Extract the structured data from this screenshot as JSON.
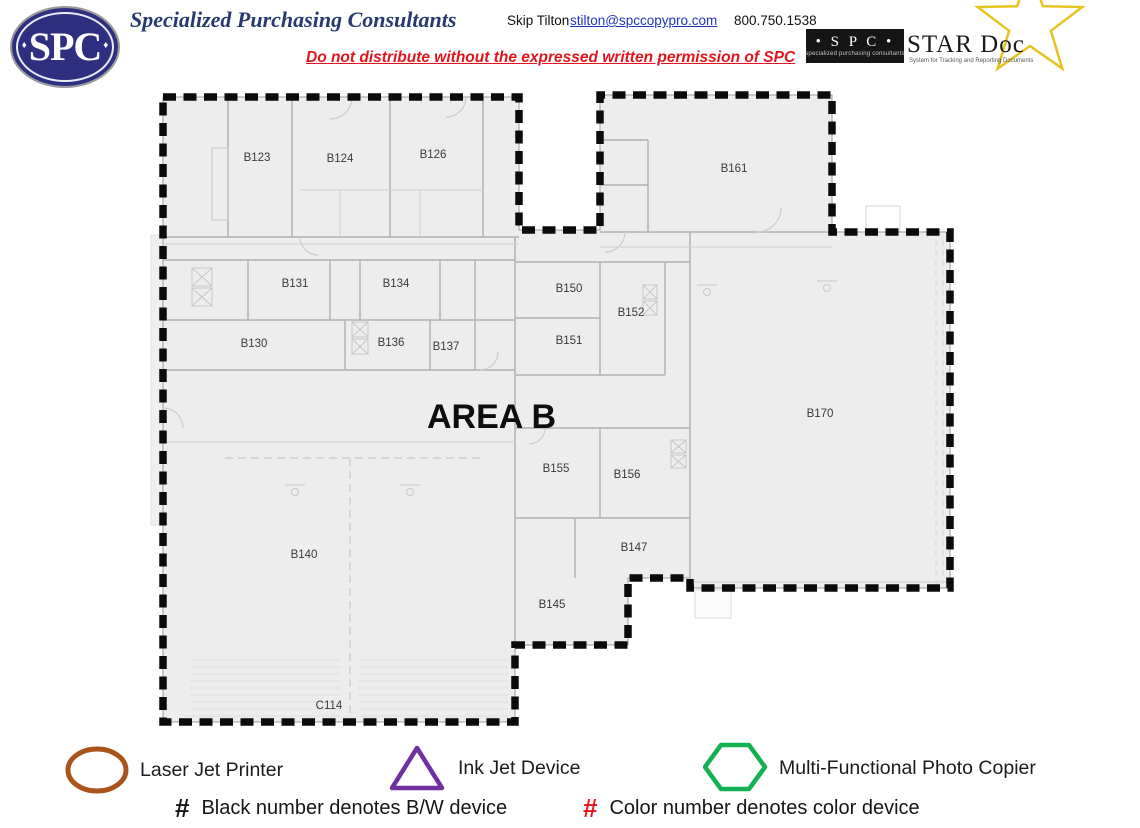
{
  "header": {
    "logo_text": "SPC",
    "logo_diamond": "♦",
    "company": "Specialized Purchasing Consultants",
    "contact_name": "Skip Tilton",
    "contact_email": "stilton@spccopypro.com",
    "contact_phone": "800.750.1538",
    "warning": "Do not distribute without the expressed written permission of SPC",
    "stardoc": {
      "spc_label": "• S P C •",
      "spc_sub": "specialized purchasing consultants",
      "title": "STAR Doc",
      "subtitle": "System for Tracking and Reporting Documents"
    }
  },
  "plan": {
    "area_label": "AREA B",
    "rooms": [
      {
        "label": "B123",
        "x": 257,
        "y": 161
      },
      {
        "label": "B124",
        "x": 340,
        "y": 162
      },
      {
        "label": "B126",
        "x": 433,
        "y": 158
      },
      {
        "label": "B161",
        "x": 734,
        "y": 172
      },
      {
        "label": "B131",
        "x": 295,
        "y": 287
      },
      {
        "label": "B134",
        "x": 396,
        "y": 287
      },
      {
        "label": "B150",
        "x": 569,
        "y": 292
      },
      {
        "label": "B152",
        "x": 631,
        "y": 316
      },
      {
        "label": "B130",
        "x": 254,
        "y": 347
      },
      {
        "label": "B136",
        "x": 391,
        "y": 346
      },
      {
        "label": "B137",
        "x": 446,
        "y": 350
      },
      {
        "label": "B151",
        "x": 569,
        "y": 344
      },
      {
        "label": "B170",
        "x": 820,
        "y": 417
      },
      {
        "label": "B155",
        "x": 556,
        "y": 472
      },
      {
        "label": "B156",
        "x": 627,
        "y": 478
      },
      {
        "label": "B147",
        "x": 634,
        "y": 551
      },
      {
        "label": "B140",
        "x": 304,
        "y": 558
      },
      {
        "label": "B145",
        "x": 552,
        "y": 608
      },
      {
        "label": "C114",
        "x": 329,
        "y": 709
      }
    ]
  },
  "legend": {
    "items": [
      {
        "name": "laser-jet-printer",
        "shape": "oval",
        "color": "#a9541c",
        "label": "Laser Jet Printer"
      },
      {
        "name": "ink-jet-device",
        "shape": "triangle",
        "color": "#7030a0",
        "label": "Ink Jet Device"
      },
      {
        "name": "multi-functional-photo-copier",
        "shape": "hexagon",
        "color": "#13b152",
        "label": "Multi-Functional Photo Copier"
      }
    ],
    "notes": [
      {
        "symbol": "#",
        "symbol_color": "#141414",
        "text": "Black number denotes B/W device"
      },
      {
        "symbol": "#",
        "symbol_color": "#e8141c",
        "text": "Color number denotes color device"
      }
    ]
  },
  "colors": {
    "brand_navy": "#2e2f80",
    "title_blue": "#263a70",
    "link_blue": "#2136c0",
    "warning_red": "#e2151c",
    "star_yellow": "#e6c41f",
    "boundary_black": "#0b0b0b",
    "plan_fill": "#ededed"
  }
}
